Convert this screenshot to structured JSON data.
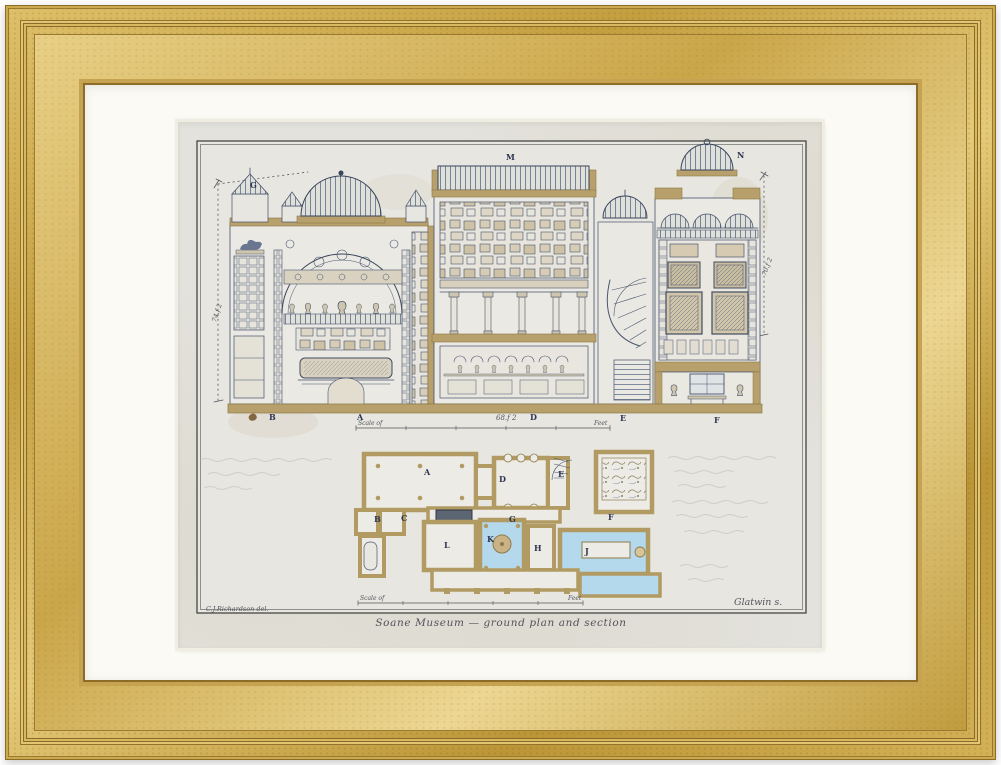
{
  "artwork": {
    "caption": "Soane Museum — ground plan and section",
    "credit_left": "C.J.Richardson del.",
    "credit_right": "Glatwin s.",
    "dim_left": "74.f 2",
    "dim_right": "70.f 2",
    "dim_width": "68.f 2",
    "scale_top": {
      "label": "Scale of",
      "feet": "Feet"
    },
    "scale_bottom": {
      "label": "Scale of",
      "feet": "Feet"
    },
    "section_labels": {
      "g": "G",
      "m": "M",
      "n": "N"
    },
    "base_labels": {
      "b": "B",
      "a": "A",
      "d": "D",
      "e": "E",
      "f": "F"
    },
    "plan_labels": {
      "a": "A",
      "b": "B",
      "c": "C",
      "d": "D",
      "e": "E",
      "f": "F",
      "g": "G",
      "h": "H",
      "j": "J",
      "k": "K",
      "l": "L"
    }
  },
  "palette": {
    "frame_gold": "#c9a44a",
    "mat_white": "#fbfaf5",
    "paper": "#e3e2dc",
    "ink": "#46526b",
    "wash_tan": "#b7a06b",
    "wash_blue": "#b5d9ec"
  }
}
